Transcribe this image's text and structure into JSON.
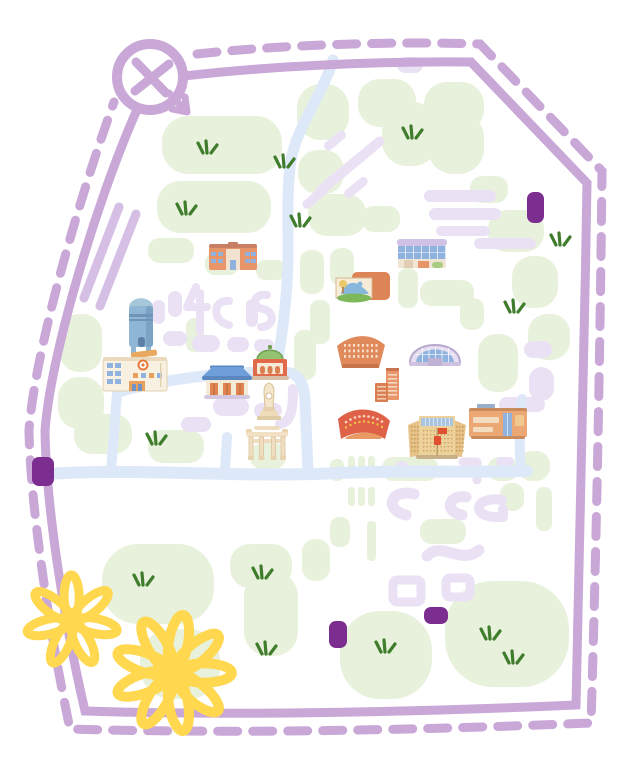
{
  "meta": {
    "title": "hand-drawn-illustrated-campus-map",
    "canvas_width": 640,
    "canvas_height": 765,
    "background": "#ffffff"
  },
  "palette": {
    "border": "#c9a7d7",
    "lavender_block": "#eae2f4",
    "lavender_road": "#d5bfe5",
    "green_patch": "#e8f1dc",
    "road_blue": "#dde8f8",
    "grass_dark": "#3f7d2c",
    "gate_purple": "#7c2d90",
    "flower_yellow": "#ffd84f",
    "building_orange": "#e8956a",
    "building_red": "#df6147",
    "roof_blue": "#6f9fd8",
    "glass_blue": "#8fb3de",
    "cream": "#f6efdf",
    "tan": "#ecd29a",
    "dome_green": "#93c270",
    "water_blue": "#8fb6d4",
    "flag_red": "#e05030"
  },
  "compass": {
    "cx": 150,
    "cy": 77,
    "r": 33
  },
  "border": {
    "solid_path": "M184,76 C270,66 380,61 471,62 L587,183 C584,360 580,540 576,705 C420,712 230,716 85,711 C62,612 46,500 45,431 C50,358 95,205 136,112",
    "dashed_path": "M197,54 C280,45 390,41 480,44 L602,171 C600,360 596,560 591,723 C420,730 240,734 70,729 C47,620 30,498 29,430 C35,350 80,196 114,102",
    "dash": "20 15",
    "width": 9
  },
  "roads": {
    "blue": [
      {
        "d": "M333,60 C322,96 297,126 291,160 C287,186 288,212 288,240 L288,262",
        "w": 11
      },
      {
        "d": "M288,262 C287,295 283,330 279,352 C278,360 277,368 275,374",
        "w": 11
      },
      {
        "d": "M118,392 C160,380 210,374 262,372 C272,371 282,371 290,373 C301,376 304,386 305,400 C306,424 307,448 308,471",
        "w": 11
      },
      {
        "d": "M46,474 C140,468 240,478 340,473 C400,470 460,473 527,471",
        "w": 12
      },
      {
        "d": "M521,469 C519,448 519,428 522,399",
        "w": 10
      },
      {
        "d": "M225,471 L227,437",
        "w": 10
      },
      {
        "d": "M117,393 L111,471",
        "w": 10
      }
    ],
    "lavender_diagonal": [
      {
        "d": "M136,214 L100,306",
        "w": 9
      },
      {
        "d": "M119,207 L84,298",
        "w": 9
      }
    ]
  },
  "blocks": {
    "lavender": [
      [
        397,
        57,
        26,
        16
      ],
      [
        424,
        190,
        72,
        12
      ],
      [
        429,
        208,
        72,
        12
      ],
      [
        436,
        226,
        54,
        10
      ],
      [
        474,
        238,
        62,
        11
      ],
      [
        163,
        331,
        24,
        15
      ],
      [
        192,
        335,
        28,
        17
      ],
      [
        227,
        337,
        22,
        15
      ],
      [
        254,
        339,
        20,
        13
      ],
      [
        246,
        299,
        12,
        28
      ],
      [
        168,
        291,
        14,
        26
      ],
      [
        152,
        300,
        13,
        24
      ],
      [
        213,
        397,
        36,
        19
      ],
      [
        254,
        403,
        28,
        15
      ],
      [
        181,
        417,
        30,
        15
      ],
      [
        524,
        341,
        28,
        17
      ],
      [
        529,
        367,
        25,
        34
      ],
      [
        499,
        397,
        46,
        15
      ],
      [
        496,
        457,
        18,
        9
      ],
      [
        395,
        461,
        14,
        13
      ]
    ],
    "lavender_rot": [
      [
        312,
        176,
        40,
        10,
        -40
      ],
      [
        330,
        161,
        40,
        10,
        -40
      ],
      [
        348,
        146,
        40,
        10,
        -40
      ],
      [
        322,
        136,
        26,
        9,
        -40
      ],
      [
        300,
        193,
        30,
        9,
        -40
      ],
      [
        342,
        183,
        28,
        9,
        -40
      ]
    ],
    "lavender_paths": [
      {
        "d": "M196,287 L187,307 L207,307",
        "w": 8
      },
      {
        "d": "M200,293 L200,331",
        "w": 8
      },
      {
        "d": "M229,301 C213,299 211,321 229,325",
        "w": 8
      },
      {
        "d": "M267,295 C253,293 251,307 263,309 C275,311 275,327 261,327",
        "w": 8
      },
      {
        "d": "M293,389 C293,410 291,422 280,424",
        "w": 10
      },
      {
        "d": "M414,494 C390,488 384,510 406,515",
        "w": 11
      },
      {
        "d": "M466,497 C448,494 444,512 462,515",
        "w": 11
      },
      {
        "d": "M502,500 C476,496 470,515 494,517 L503,517 L503,509",
        "w": 10
      },
      {
        "d": "M463,462 L477,462 L477,480",
        "w": 9
      },
      {
        "d": "M427,556 C441,540 461,566 479,550",
        "w": 11
      }
    ],
    "rings": [
      [
        393,
        580,
        28,
        22
      ],
      [
        446,
        578,
        24,
        19
      ]
    ]
  },
  "lawns": {
    "patches": [
      [
        162,
        116,
        120,
        58
      ],
      [
        157,
        181,
        114,
        52
      ],
      [
        148,
        238,
        46,
        25
      ],
      [
        205,
        253,
        34,
        22
      ],
      [
        256,
        260,
        30,
        20
      ],
      [
        297,
        84,
        52,
        56
      ],
      [
        358,
        79,
        58,
        48
      ],
      [
        424,
        82,
        60,
        50
      ],
      [
        382,
        102,
        56,
        64
      ],
      [
        428,
        112,
        56,
        62
      ],
      [
        298,
        150,
        46,
        44
      ],
      [
        308,
        194,
        58,
        42
      ],
      [
        362,
        206,
        38,
        26
      ],
      [
        470,
        176,
        38,
        27
      ],
      [
        488,
        210,
        56,
        42
      ],
      [
        512,
        256,
        46,
        52
      ],
      [
        528,
        314,
        42,
        46
      ],
      [
        330,
        248,
        24,
        38
      ],
      [
        300,
        250,
        24,
        44
      ],
      [
        398,
        268,
        20,
        40
      ],
      [
        420,
        280,
        54,
        26
      ],
      [
        460,
        298,
        24,
        32
      ],
      [
        310,
        300,
        20,
        44
      ],
      [
        294,
        330,
        22,
        50
      ],
      [
        186,
        318,
        18,
        34
      ],
      [
        478,
        334,
        40,
        58
      ],
      [
        60,
        314,
        42,
        58
      ],
      [
        58,
        377,
        46,
        52
      ],
      [
        74,
        414,
        58,
        40
      ],
      [
        148,
        430,
        56,
        33
      ],
      [
        250,
        443,
        36,
        26
      ],
      [
        382,
        457,
        56,
        24
      ],
      [
        488,
        457,
        30,
        24
      ],
      [
        518,
        451,
        32,
        30
      ],
      [
        330,
        459,
        14,
        22
      ],
      [
        500,
        483,
        24,
        28
      ],
      [
        536,
        487,
        16,
        44
      ],
      [
        330,
        517,
        20,
        30
      ],
      [
        420,
        519,
        46,
        25
      ],
      [
        367,
        521,
        9,
        40
      ],
      [
        102,
        544,
        112,
        80
      ],
      [
        230,
        544,
        62,
        44
      ],
      [
        302,
        539,
        28,
        42
      ],
      [
        244,
        572,
        54,
        84
      ],
      [
        140,
        629,
        80,
        70
      ],
      [
        340,
        611,
        92,
        88
      ],
      [
        445,
        581,
        124,
        106
      ]
    ],
    "bars": [
      [
        348,
        456,
        7,
        22
      ],
      [
        358,
        456,
        7,
        22
      ],
      [
        368,
        456,
        7,
        22
      ],
      [
        348,
        487,
        7,
        19
      ],
      [
        358,
        487,
        7,
        19
      ],
      [
        368,
        487,
        7,
        19
      ]
    ]
  },
  "grass_tufts": [
    [
      207,
      151
    ],
    [
      186,
      212
    ],
    [
      284,
      165
    ],
    [
      412,
      136
    ],
    [
      300,
      224
    ],
    [
      514,
      310
    ],
    [
      560,
      243
    ],
    [
      156,
      442
    ],
    [
      143,
      583
    ],
    [
      262,
      576
    ],
    [
      385,
      650
    ],
    [
      266,
      652
    ],
    [
      490,
      637
    ],
    [
      513,
      661
    ]
  ],
  "gate_markers": [
    [
      527,
      192,
      17,
      31
    ],
    [
      32,
      457,
      22,
      29
    ],
    [
      329,
      621,
      18,
      27
    ],
    [
      424,
      607,
      24,
      17
    ]
  ],
  "buildings": [
    {
      "name": "classroom-building-north",
      "kind": "classroom",
      "x": 209,
      "y": 242
    },
    {
      "name": "modern-library",
      "kind": "library",
      "x": 397,
      "y": 239
    },
    {
      "name": "museum-with-mural",
      "kind": "museum",
      "x": 336,
      "y": 272
    },
    {
      "name": "water-tower",
      "kind": "watertower",
      "x": 126,
      "y": 292
    },
    {
      "name": "fan-lecture-hall",
      "kind": "fan",
      "x": 336,
      "y": 333
    },
    {
      "name": "domed-gymnasium",
      "kind": "arena",
      "x": 409,
      "y": 332
    },
    {
      "name": "orange-highrise",
      "kind": "highrise",
      "x": 375,
      "y": 368
    },
    {
      "name": "cream-office-building",
      "kind": "cream",
      "x": 103,
      "y": 351
    },
    {
      "name": "green-dome-auditorium",
      "kind": "greendome",
      "x": 251,
      "y": 344
    },
    {
      "name": "blue-roof-hall",
      "kind": "bluehall",
      "x": 202,
      "y": 365
    },
    {
      "name": "monument-obelisk",
      "kind": "monument",
      "x": 257,
      "y": 383
    },
    {
      "name": "campus-gate-paifang",
      "kind": "paifang",
      "x": 246,
      "y": 426
    },
    {
      "name": "red-stadium",
      "kind": "redstadium",
      "x": 337,
      "y": 404
    },
    {
      "name": "main-building-with-flag",
      "kind": "mainbuilding",
      "x": 406,
      "y": 410
    },
    {
      "name": "orange-slab-building",
      "kind": "orangeslab",
      "x": 469,
      "y": 403
    }
  ],
  "flowers": [
    {
      "cx": 72,
      "cy": 621,
      "r": 47,
      "petals": 7,
      "stroke_width": 9,
      "rot": 12
    },
    {
      "cx": 173,
      "cy": 673,
      "r": 60,
      "petals": 9,
      "stroke_width": 10,
      "rot": 0
    }
  ]
}
